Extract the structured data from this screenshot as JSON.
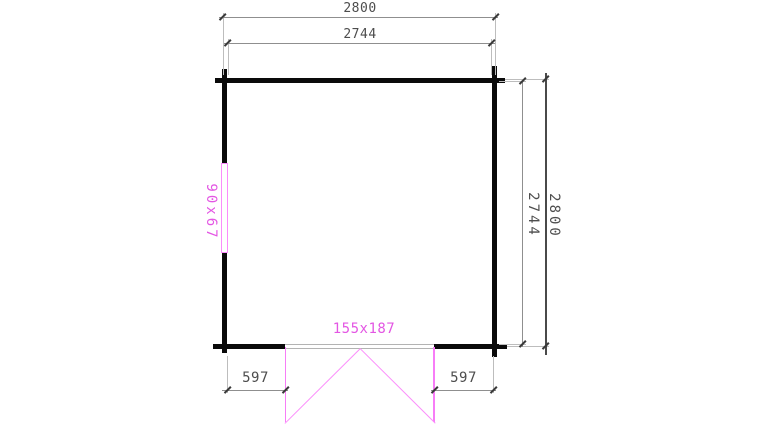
{
  "drawing": {
    "type": "floor-plan",
    "labels": {
      "width_outer": "2800",
      "width_inner": "2744",
      "height_inner": "2744",
      "height_outer": "2800",
      "door_left_offset": "597",
      "door_right_offset": "597",
      "door_size": "155x187",
      "window_size": "90x67"
    },
    "colors": {
      "wall": "#0a0a0a",
      "dimension_line": "#8f8f8f",
      "extension_line": "#bdbdbd",
      "tick": "#3a3a3a",
      "dimension_text": "#4d4d4d",
      "magenta_text": "#e356e3",
      "pink_line": "#f77df7",
      "background": "#ffffff"
    }
  }
}
